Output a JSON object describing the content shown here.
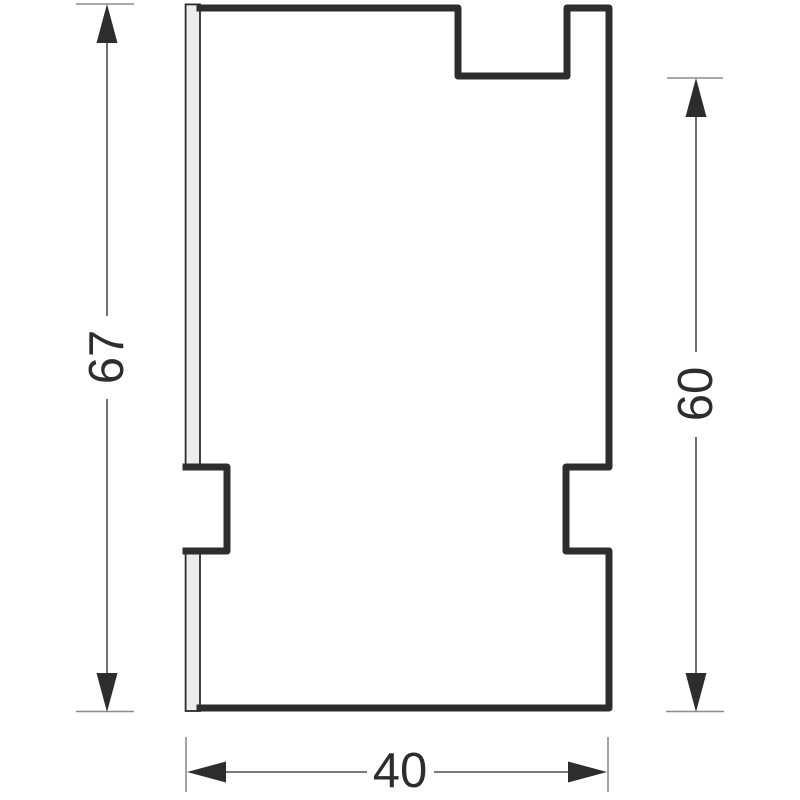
{
  "drawing": {
    "type": "technical-dimension-drawing",
    "dimensions": {
      "left_height": {
        "value": "67",
        "orientation": "vertical",
        "side": "left"
      },
      "right_height": {
        "value": "60",
        "orientation": "vertical",
        "side": "right"
      },
      "bottom_width": {
        "value": "40",
        "orientation": "horizontal",
        "side": "bottom"
      }
    },
    "colors": {
      "outline": "#2d2d2d",
      "dimension_line": "#4d4d4d",
      "extension_line": "#8c8c8c",
      "arrow": "#2d2d2d",
      "strip_fill": "#ececec",
      "strip_stroke": "#2b2b2b",
      "text": "#2d2d2d",
      "background": "#ffffff"
    }
  }
}
